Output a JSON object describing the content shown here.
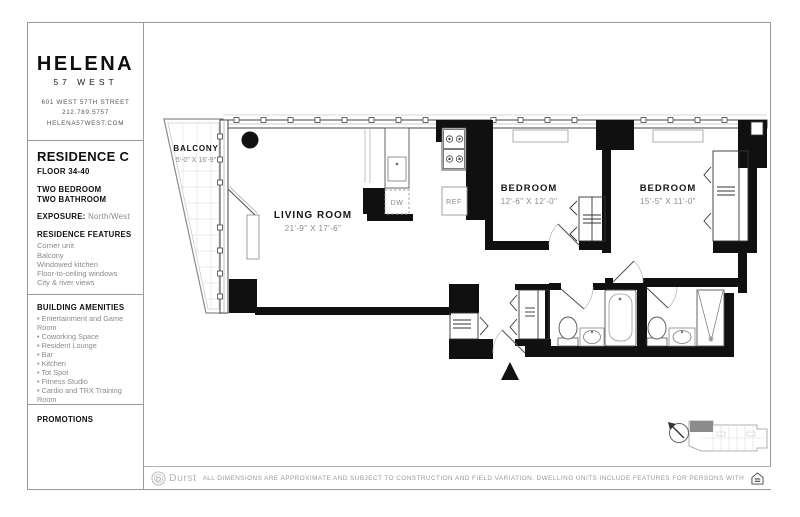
{
  "brand": {
    "name": "HELENA",
    "sub": "57 WEST",
    "address": "601 WEST 57TH STREET",
    "phone": "212.789.5757",
    "website": "HELENA57WEST.COM"
  },
  "residence": {
    "title": "RESIDENCE C",
    "floor": "FLOOR 34-40",
    "config_line1": "TWO BEDROOM",
    "config_line2": "TWO BATHROOM",
    "exposure_label": "EXPOSURE:",
    "exposure_value": "North/West",
    "features_heading": "RESIDENCE FEATURES",
    "features": [
      "Corner unit",
      "Balcony",
      "Windowed kitchen",
      "Floor-to-ceiling windows",
      "City & river views"
    ],
    "rent_heading": "MONTHLY RENT"
  },
  "amenities": {
    "heading": "BUILDING AMENITIES",
    "items": [
      "Entertainment and Game Room",
      "Coworking Space",
      "Resident Lounge",
      "Bar",
      "Kitchen",
      "Tot Spot",
      "Fitness Studio",
      "Cardio and TRX Training Room",
      "Strength Training Room"
    ]
  },
  "promotions": {
    "heading": "PROMOTIONS"
  },
  "floorplan": {
    "balcony": {
      "name": "BALCONY",
      "dims": "5'-0\" X 16'-9\""
    },
    "living_room": {
      "name": "LIVING ROOM",
      "dims": "21'-9\" X 17'-6\""
    },
    "bedroom1": {
      "name": "BEDROOM",
      "dims": "12'-6\" X 12'-0\""
    },
    "bedroom2": {
      "name": "BEDROOM",
      "dims": "15'-5\" X 11'-0\""
    },
    "appliances": {
      "dishwasher": "DW",
      "refrigerator": "REF"
    }
  },
  "footer": {
    "logo_mark": "D",
    "logo_text": "Durst",
    "disclaimer": "ALL DIMENSIONS ARE APPROXIMATE AND SUBJECT TO CONSTRUCTION AND FIELD VARIATION.  DWELLING UNITS INCLUDE FEATURES FOR PERSONS WITH DISABILITIES REQUIRED BY THE FHA."
  },
  "colors": {
    "wall": "#101010",
    "line": "#444444",
    "light_line": "#cccccc",
    "text_gray": "#8a8a8a",
    "heading": "#101010"
  }
}
